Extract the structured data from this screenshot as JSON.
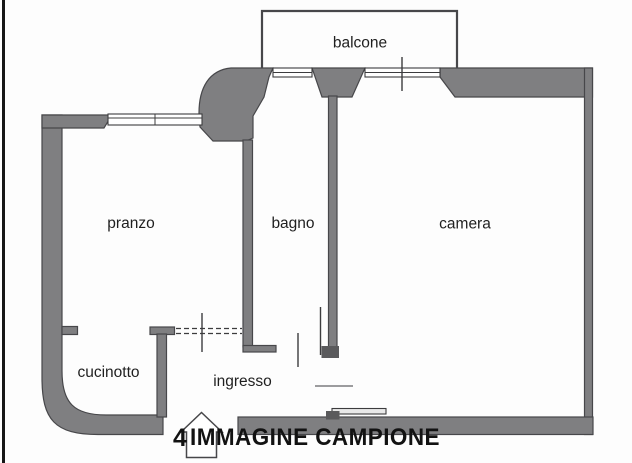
{
  "document": {
    "type": "apartment floor plan",
    "language": "it"
  },
  "colors": {
    "background": "#fdfdfd",
    "border": "#161616",
    "wall_fill": "#7f7f81",
    "wall_stroke": "#47474a",
    "line": "#3c3c3e",
    "window_fill": "#ffffff",
    "label": "#1f1f1f",
    "watermark": "#121212",
    "door_panel": "#e9e9e9",
    "hinge": "#5a5a5c"
  },
  "rooms": {
    "balcone": {
      "label": "balcone"
    },
    "pranzo": {
      "label": "pranzo"
    },
    "bagno": {
      "label": "bagno"
    },
    "camera": {
      "label": "camera"
    },
    "cucinotto": {
      "label": "cucinotto"
    },
    "ingresso": {
      "label": "ingresso"
    }
  },
  "watermark": {
    "prefix": "4",
    "text": "IMMAGINE CAMPIONE"
  }
}
